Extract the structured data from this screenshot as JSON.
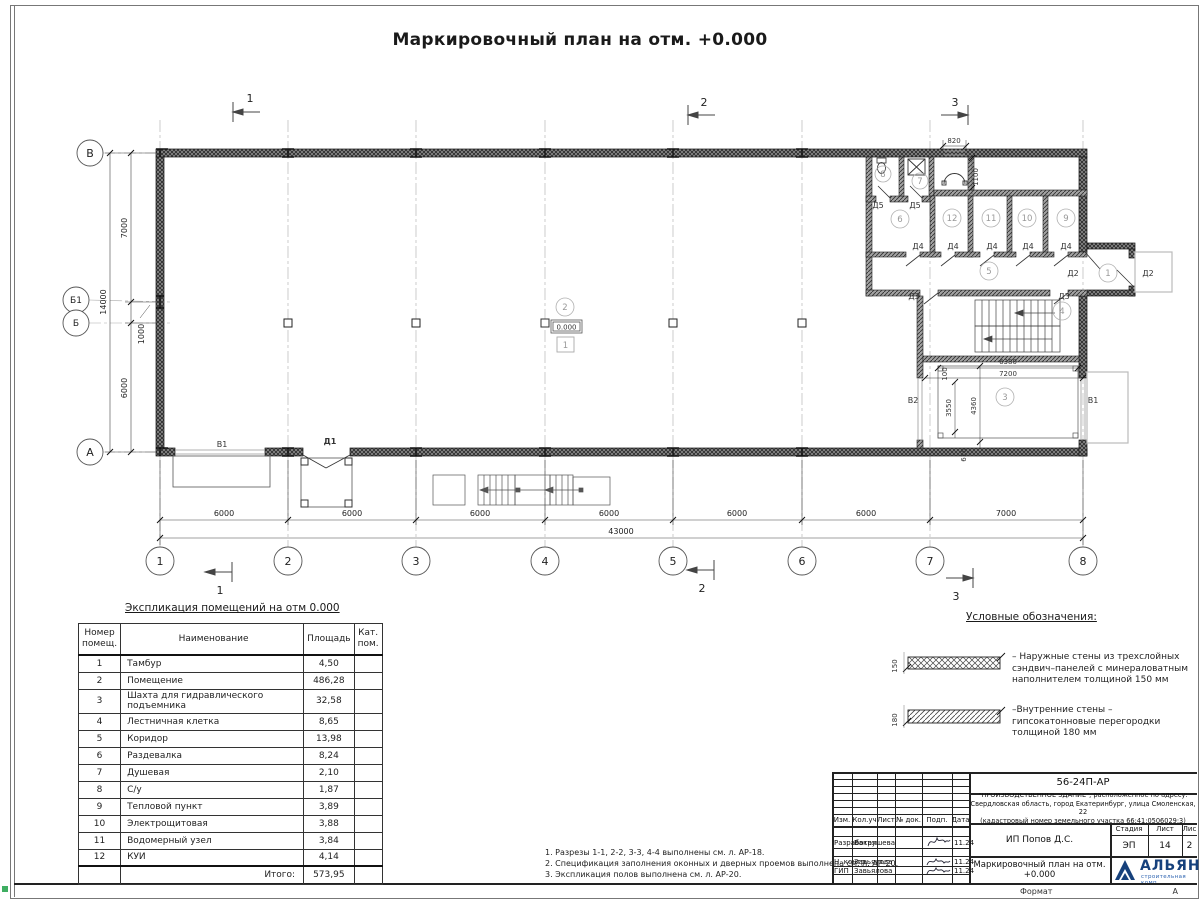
{
  "sheet": {
    "title": "Маркировочный план на отм. +0.000",
    "format_label": "Формат",
    "format_value": "А"
  },
  "plan": {
    "axes_bottom": [
      "1",
      "2",
      "3",
      "4",
      "5",
      "6",
      "7",
      "8"
    ],
    "axes_left": [
      "В",
      "Б1",
      "Б",
      "А"
    ],
    "dims_bottom": [
      "6000",
      "6000",
      "6000",
      "6000",
      "6000",
      "6000",
      "7000"
    ],
    "dim_total_bottom": "43000",
    "dims_left": [
      "7000",
      "1000",
      "6000"
    ],
    "dim_total_left": "14000",
    "section_markers": [
      "1",
      "2",
      "3"
    ],
    "rooms": [
      "1",
      "2",
      "3",
      "4",
      "5",
      "6",
      "7",
      "8",
      "9",
      "10",
      "11",
      "12"
    ],
    "elevation_mark": "0.000",
    "floor_type_mark": "1",
    "doors": {
      "d1": "Д1",
      "d2": "Д2",
      "d3": "Д3",
      "d4": "Д4",
      "d5": "Д5"
    },
    "gates": {
      "v1": "В1",
      "v2": "В2"
    },
    "detail_dims": {
      "niche_w": "820",
      "niche_d": "1100",
      "pit_w1": "6380",
      "pit_w2": "7200",
      "off": "100",
      "pit_h1": "3550",
      "pit_h2": "4360",
      "bot": "610"
    }
  },
  "explication": {
    "title": "Экспликация помещений на отм 0.000",
    "headers": {
      "num1": "Номер",
      "num2": "помещ.",
      "name": "Наименование",
      "area": "Площадь",
      "cat1": "Кат.",
      "cat2": "пом."
    },
    "rows": [
      {
        "n": "1",
        "name": "Тамбур",
        "area": "4,50"
      },
      {
        "n": "2",
        "name": "Помещение",
        "area": "486,28"
      },
      {
        "n": "3",
        "name": "Шахта для гидравлического подъемника",
        "area": "32,58"
      },
      {
        "n": "4",
        "name": "Лестничная клетка",
        "area": "8,65"
      },
      {
        "n": "5",
        "name": "Коридор",
        "area": "13,98"
      },
      {
        "n": "6",
        "name": "Раздевалка",
        "area": "8,24"
      },
      {
        "n": "7",
        "name": "Душевая",
        "area": "2,10"
      },
      {
        "n": "8",
        "name": "С/у",
        "area": "1,87"
      },
      {
        "n": "9",
        "name": "Тепловой пункт",
        "area": "3,89"
      },
      {
        "n": "10",
        "name": "Электрощитовая",
        "area": "3,88"
      },
      {
        "n": "11",
        "name": "Водомерный узел",
        "area": "3,84"
      },
      {
        "n": "12",
        "name": "КУИ",
        "area": "4,14"
      }
    ],
    "total_label": "Итого:",
    "total_value": "573,95"
  },
  "legend": {
    "title": "Условные обозначения:",
    "items": [
      {
        "dim": "150",
        "lines": [
          "– Наружные стены из трехслойных",
          "сэндвич–панелей с минераловатным",
          "наполнителем толщиной 150 мм"
        ]
      },
      {
        "dim": "180",
        "lines": [
          "–Внутренние стены –",
          "гипсокатонновые перегородки",
          "толщиной 180 мм"
        ]
      }
    ]
  },
  "notes": [
    "1. Разрезы 1-1, 2-2, 3-3, 4-4 выполнены см. л. АР-18.",
    "2. Спецификация заполнения оконных и дверных проемов выполнена см. л. АР-20.",
    "3. Экспликация полов выполнена см. л. АР-20."
  ],
  "titleblock": {
    "doc_number": "56-24П-АР",
    "project_lines": [
      "\"ПРОИЗВОДСТВЕННОЕ ЗДАНИЕ\", расположенное по адресу:",
      "Свердловская область, город Екатеринбург, улица Смоленская, 22",
      "(кадастровый номер земельного участка 66:41:0506029:3)"
    ],
    "cols": [
      "Изм.",
      "Кол.уч",
      "Лист",
      "№ док.",
      "Подп.",
      "Дата"
    ],
    "rows": [
      {
        "role": "Разработал",
        "name": "Вакрушева",
        "date": "11.24"
      },
      {
        "role": "Н. контр.",
        "name": "Завьялова",
        "date": "11.24"
      },
      {
        "role": "ГИП",
        "name": "Завьялова",
        "date": "11.24"
      }
    ],
    "client": "ИП Попов Д.С.",
    "stage_label": "Стадия",
    "sheet_label": "Лист",
    "sheets_label": "Лис",
    "stage": "ЭП",
    "sheet_num": "14",
    "sheets_num": "2",
    "drawing_title": "Маркировочный план на отм. +0.000",
    "logo_text": "АЛЬЯН",
    "logo_sub": "строительная комп"
  },
  "colors": {
    "wall": "#4a4a4a",
    "accent_blue": "#16417c",
    "green_mark": "#3fae62"
  }
}
